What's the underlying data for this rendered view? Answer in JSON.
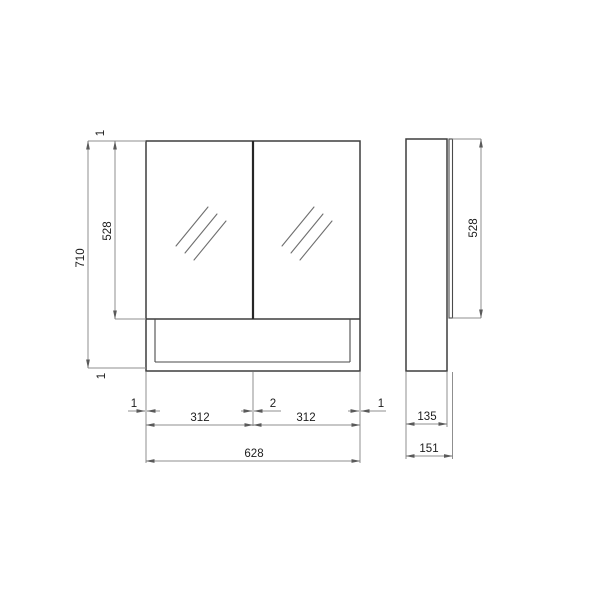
{
  "figure": {
    "kind": "technical-dimension-drawing",
    "subject": "mirror-cabinet",
    "background_color": "#ffffff",
    "object_line_color": "#3d3d3d",
    "dimension_line_color": "#8f8f8f",
    "text_color": "#1c1c1c"
  },
  "front_view": {
    "height_total": "710",
    "door_height": "528",
    "gap_top": "1",
    "gap_bottom": "1",
    "gap_left": "1",
    "gap_center": "2",
    "gap_right": "1",
    "door_width_left": "312",
    "door_width_right": "312",
    "width_total": "628"
  },
  "side_view": {
    "door_height": "528",
    "body_depth": "135",
    "depth_total": "151"
  }
}
